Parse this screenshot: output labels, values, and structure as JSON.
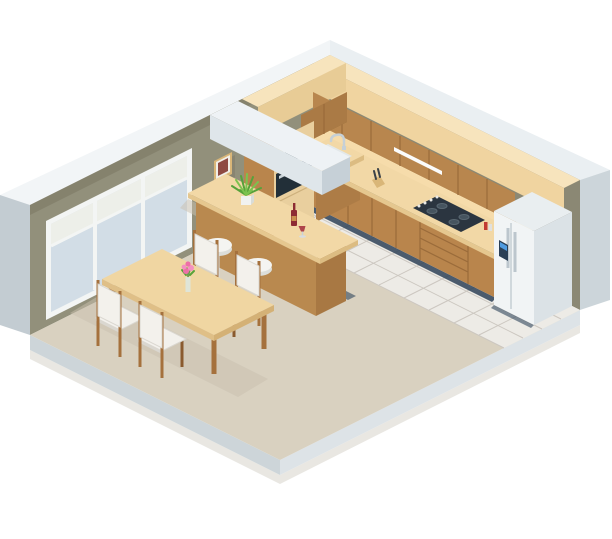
{
  "scene": {
    "title": "Isometric kitchen and dining room interior illustration",
    "description": "Cutaway isometric vector illustration of an apartment kitchen-dining room: L-shaped brown kitchen cabinets with peach countertop, built-in microwave and oven column, gas cooktop, corner sink with faucet, side-by-side refrigerator, white ceiling beam, bar counter with two white stools, spider plant, wine bottle and glass, dining table with four chairs and a vase of pink flowers, large window on the left wall, framed picture, tiled kitchen floor and beige carpet.",
    "objects": [
      "window",
      "picture-frame",
      "ceiling-beam",
      "upper-cabinets",
      "soffit",
      "tall-cabinet",
      "microwave",
      "oven",
      "base-cabinets",
      "countertop",
      "sink",
      "faucet",
      "knife-block",
      "gas-cooktop",
      "spice-jars",
      "under-cabinet-light",
      "drawer-stack",
      "refrigerator",
      "water-dispenser",
      "bar-counter",
      "spider-plant",
      "wine-bottle",
      "wine-glass",
      "bar-stool",
      "dining-table",
      "dining-chair",
      "flower-vase",
      "tile-floor",
      "carpet-floor",
      "outer-shell"
    ],
    "colors": {
      "page_bg": "#ffffff",
      "shell_top": "#eaeff2",
      "shell_top_b": "#f2f5f7",
      "shell_cut_right": "#ccd5da",
      "shell_cut_left": "#c3ccd2",
      "slab_front_left": "#cdd5d9",
      "slab_front_right": "#dde3e7",
      "slab_shadow": "#e0ddd5",
      "wall_left": "#92907b",
      "wall_right": "#8b8874",
      "wall_top_shade": "#82806b",
      "backsplash": "#f6dcab",
      "carpet": "#d9d1c0",
      "tile": "#edebe6",
      "tile_line": "#ccc7c0",
      "soffit_front": "#f0d4a0",
      "soffit_side": "#e8cc96",
      "soffit_top": "#f7e4bd",
      "upper_front_right": "#b8864e",
      "upper_front_left": "#aa7a45",
      "cabinet_underside": "#8f6434",
      "cabinet_line": "#9a6b3a",
      "base_front": "#b9854c",
      "base_side": "#ad7c46",
      "counter_top": "#f2d8a6",
      "counter_edge": "#e5c78f",
      "counter_end": "#dcbc82",
      "toe_kick": "#2e4257",
      "tall_front": "#e9cf9e",
      "tall_side": "#b9854c",
      "tall_seam": "#cdb07c",
      "microwave_body": "#eef1f2",
      "microwave_window": "#2b3a44",
      "oven_body": "#222f38",
      "steel": "#cbd4d8",
      "fridge_front": "#f1f4f5",
      "fridge_side": "#dbe2e6",
      "fridge_top": "#e9eef0",
      "fridge_line": "#c5ced4",
      "dispenser_panel": "#2a3f55",
      "dispenser_screen": "#4f9be0",
      "beam_front": "#dfe6ea",
      "beam_end": "#c6d0d7",
      "beam_top": "#eef2f5",
      "bar_front": "#b9894f",
      "bar_end": "#a87843",
      "stool_seat": "#f4f4f1",
      "stool_rim": "#dcdeda",
      "stool_pole": "#d7dbde",
      "table_top": "#f0d6a2",
      "table_edge": "#dfbf87",
      "table_end": "#d4b176",
      "wood": "#a5713d",
      "wood_dark": "#8a5a2e",
      "chair_pad": "#f3f1ec",
      "chair_pad_edge": "#dad7d0",
      "window_frame": "#f3f5f4",
      "window_glass": "#d2dde6",
      "window_glass_upper": "#edefe9",
      "picture_frame": "#d9b678",
      "picture_mat": "#f1efe8",
      "picture_art": "#8e4a42",
      "plant_green": "#57a23a",
      "plant_green_light": "#7cc24e",
      "pot": "#f1f2f0",
      "pot_side": "#d9dcd8",
      "wine": "#8d2b33",
      "wine_label": "#c98f4e",
      "flower_pink": "#ee6fa7",
      "flower_pink_light": "#f48fc0",
      "flower_stem": "#6f9c4f",
      "sink_rim": "#e3e8e9",
      "sink_basin": "#aeb9bd",
      "chrome": "#c6d0d6",
      "cooktop": "#2b3540",
      "burner": "#46545f",
      "burner_rim": "#5a6872",
      "knob": "#e8e8e6",
      "knife_block": "#d9b678",
      "knife_dark": "#3a4147",
      "light_strip": "#fbfcfc",
      "spice_red": "#c23b32",
      "spice_white": "#e0e0de",
      "shadow_soft": "#c9c0ae",
      "shadow_navy": "#31465c",
      "glass_vase": "#dce8e2"
    }
  }
}
